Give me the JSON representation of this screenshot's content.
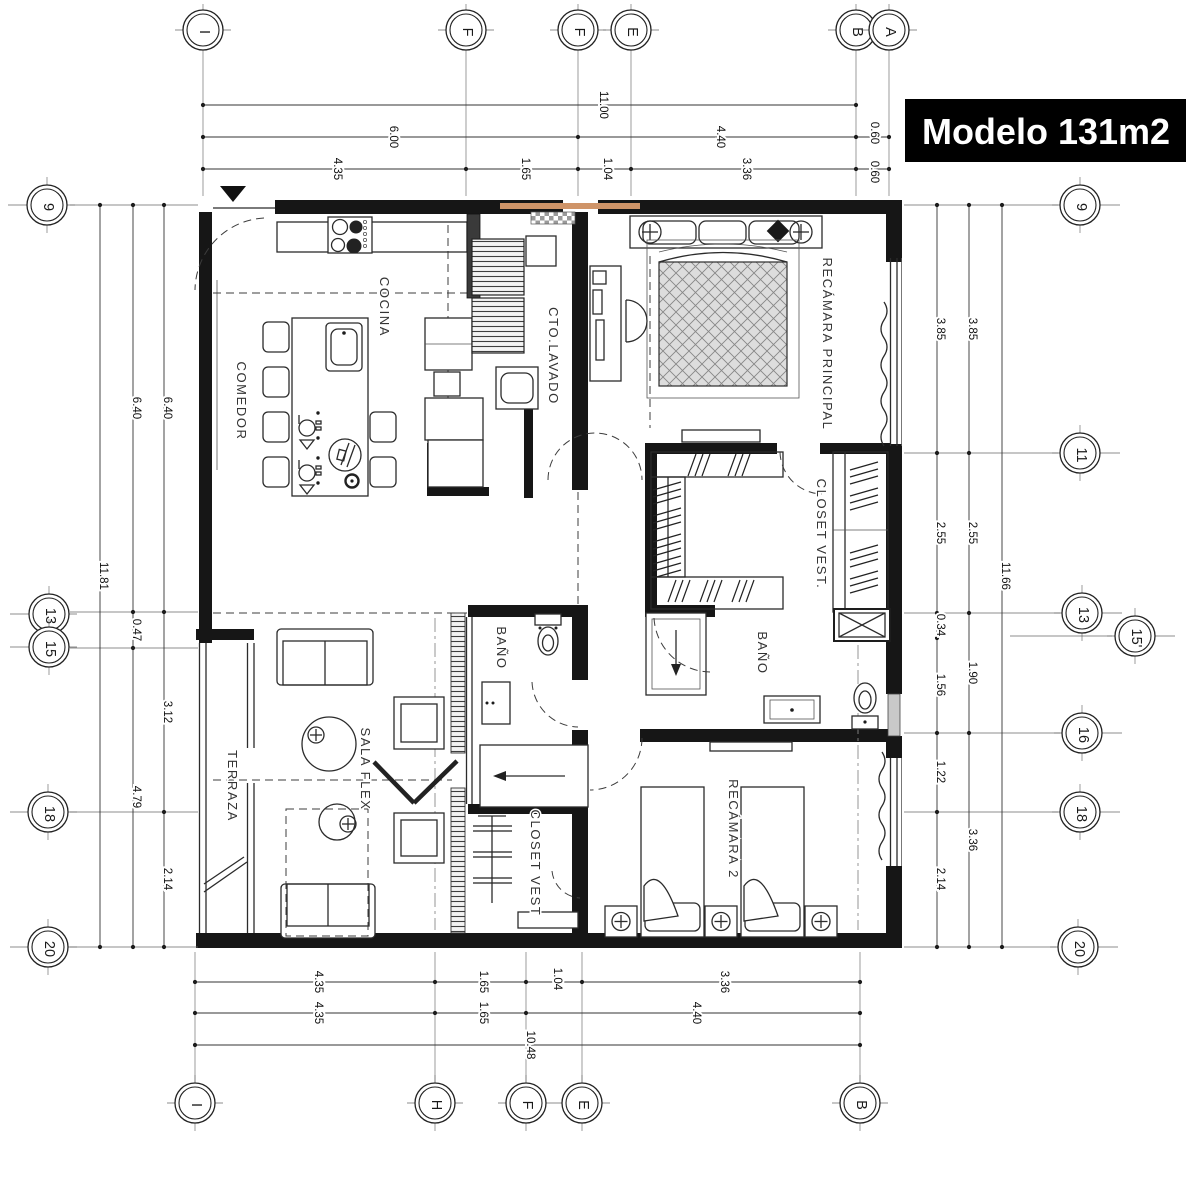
{
  "title": "Modelo 131m2",
  "colors": {
    "accent": "#cf9468",
    "wall": "#161616",
    "paper": "#ffffff"
  },
  "entry": {
    "icon": "entry-arrow"
  },
  "rooms": {
    "cocina": "COCINA",
    "comedor": "COMEDOR",
    "cto_lavado": "CTO.LAVADO",
    "recamara_principal": "RECÁMARA PRINCIPAL",
    "closet_vest": "CLOSET VEST.",
    "bano_principal": "BAÑO",
    "bano_2": "BAÑO",
    "terraza": "TERRAZA",
    "sala_flex": "SALA FLEX",
    "closet_vest_2": "CLOSET VEST",
    "recamara_2": "RECÁMARA 2"
  },
  "grid": {
    "top": [
      "I",
      "F",
      "F",
      "E",
      "B",
      "A"
    ],
    "bottom": [
      "I",
      "H",
      "F",
      "E",
      "B"
    ],
    "left": [
      "9",
      "13",
      "15",
      "18",
      "20"
    ],
    "right": [
      "9",
      "11",
      "13",
      "15'",
      "16",
      "18",
      "20"
    ]
  },
  "dims": {
    "top1": [
      "11.00"
    ],
    "top2": [
      "6.00",
      "4.40",
      "0.60"
    ],
    "top3": [
      "4.35",
      "1.65",
      "1.04",
      "3.36",
      "0.60"
    ],
    "bottom1": [
      "4.35",
      "1.65",
      "1.04",
      "3.36"
    ],
    "bottom2": [
      "4.35",
      "1.65",
      "4.40"
    ],
    "bottom3": [
      "10.48"
    ],
    "left_outer": [
      "11.81"
    ],
    "left_mid": [
      "6.40",
      "0.47",
      "4.79"
    ],
    "left_inner": [
      "6.40",
      "3.12",
      "2.14"
    ],
    "right_inner": [
      "3.85",
      "2.55",
      "0.34",
      "1.56",
      "1.22",
      "2.14"
    ],
    "right_mid": [
      "3.85",
      "2.55",
      "1.90",
      "3.36"
    ],
    "right_outer": [
      "11.66"
    ]
  }
}
